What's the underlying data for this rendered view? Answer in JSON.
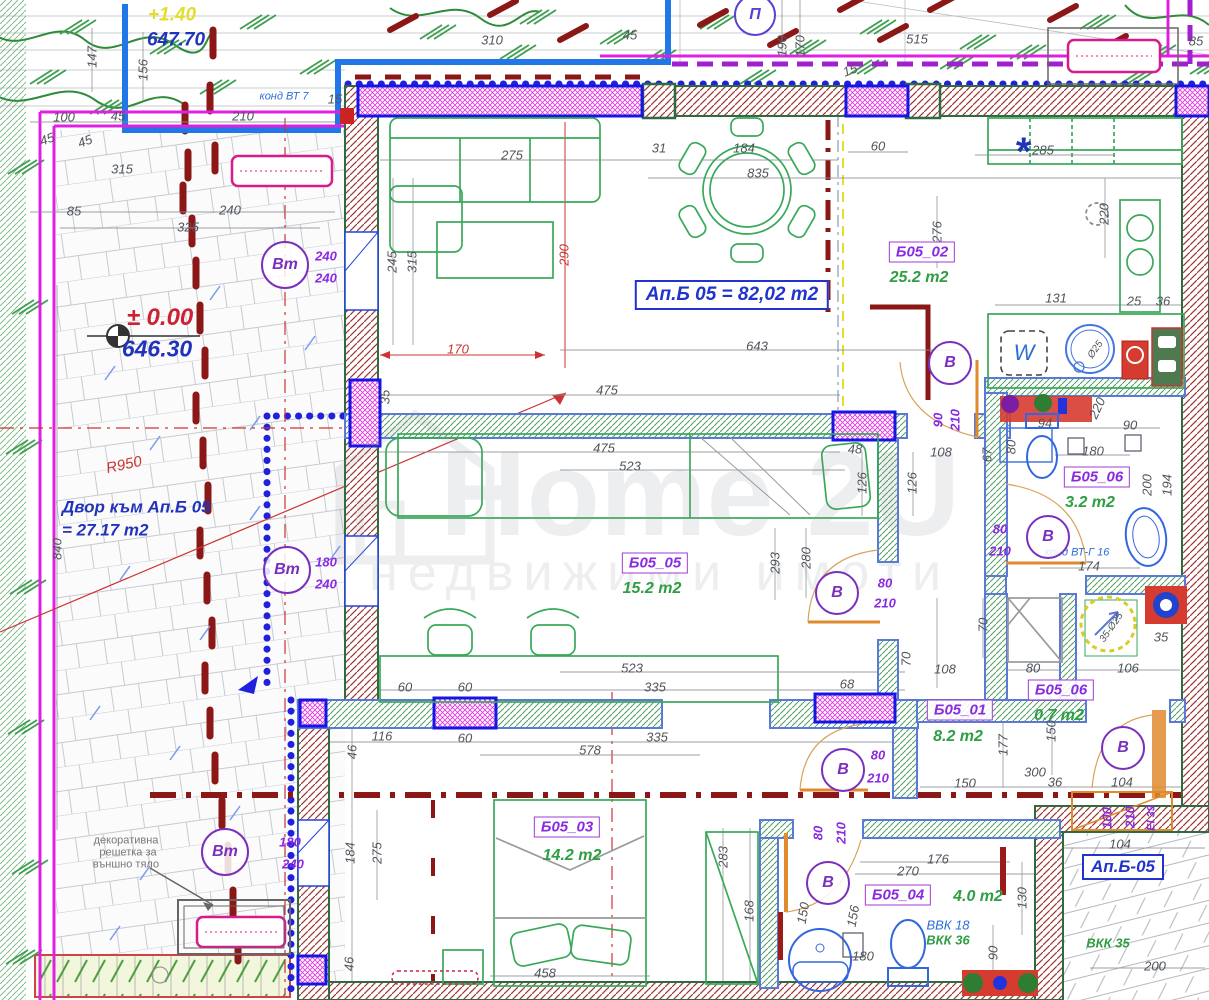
{
  "watermark": {
    "line1": "Home 2U",
    "line2": "недвижими имоти"
  },
  "boxes": [
    {
      "t": "Ап.Б 05 = 82,02 m2",
      "x": 732,
      "y": 295,
      "cls": "title",
      "n": "apartment-title"
    },
    {
      "t": "Ап.Б-05",
      "x": 1123,
      "y": 867,
      "cls": "apt",
      "n": "terrace-label"
    }
  ],
  "rooms": [
    {
      "id": "Б05_02",
      "area": "25.2 m2",
      "lx": 922,
      "ly": 252,
      "ax": 919,
      "ay": 278
    },
    {
      "id": "Б05_05",
      "area": "15.2 m2",
      "lx": 655,
      "ly": 563,
      "ax": 652,
      "ay": 589
    },
    {
      "id": "Б05_06",
      "area": "3.2 m2",
      "lx": 1097,
      "ly": 477,
      "ax": 1090,
      "ay": 503
    },
    {
      "id": "Б05_06",
      "area": "0.7 m2",
      "lx": 1061,
      "ly": 690,
      "ax": 1059,
      "ay": 716
    },
    {
      "id": "Б05_01",
      "area": "8.2 m2",
      "lx": 960,
      "ly": 710,
      "ax": 958,
      "ay": 737
    },
    {
      "id": "Б05_03",
      "area": "14.2 m2",
      "lx": 567,
      "ly": 827,
      "ax": 572,
      "ay": 856
    },
    {
      "id": "Б05_04",
      "area": "4.0 m2",
      "lx": 898,
      "ly": 895,
      "ax": 978,
      "ay": 897
    }
  ],
  "door_circles": [
    {
      "t": "Вт",
      "x": 285,
      "y": 265,
      "k": "vt"
    },
    {
      "t": "Вт",
      "x": 287,
      "y": 570,
      "k": "vt"
    },
    {
      "t": "Вт",
      "x": 225,
      "y": 852,
      "k": "vt"
    },
    {
      "t": "В",
      "x": 950,
      "y": 363,
      "k": "v"
    },
    {
      "t": "В",
      "x": 1048,
      "y": 537,
      "k": "v"
    },
    {
      "t": "В",
      "x": 837,
      "y": 593,
      "k": "v"
    },
    {
      "t": "В",
      "x": 1123,
      "y": 748,
      "k": "v"
    },
    {
      "t": "В",
      "x": 843,
      "y": 770,
      "k": "v"
    },
    {
      "t": "В",
      "x": 828,
      "y": 883,
      "k": "v"
    },
    {
      "t": "П",
      "x": 755,
      "y": 15,
      "k": "p"
    }
  ],
  "annotations": [
    {
      "t": "+1.40",
      "x": 172,
      "y": 15,
      "c": "yellow",
      "s": 19,
      "n": "level-top"
    },
    {
      "t": "647.70",
      "x": 176,
      "y": 40,
      "c": "blueb",
      "s": 19,
      "n": "elevation-647"
    },
    {
      "t": "конд ВТ 7",
      "x": 284,
      "y": 97,
      "c": "blue",
      "s": 11,
      "n": "cond-vt7"
    },
    {
      "t": "147",
      "x": 92,
      "y": 57,
      "r": -90
    },
    {
      "t": "156",
      "x": 143,
      "y": 70,
      "r": -90
    },
    {
      "t": "100",
      "x": 64,
      "y": 117
    },
    {
      "t": "45",
      "x": 118,
      "y": 116
    },
    {
      "t": "210",
      "x": 243,
      "y": 116
    },
    {
      "t": "15",
      "x": 335,
      "y": 99
    },
    {
      "t": "310",
      "x": 492,
      "y": 40
    },
    {
      "t": "45",
      "x": 630,
      "y": 35
    },
    {
      "t": "15",
      "x": 850,
      "y": 70,
      "r": -20
    },
    {
      "t": "190",
      "x": 782,
      "y": 46,
      "r": -90
    },
    {
      "t": "170",
      "x": 800,
      "y": 46,
      "r": -90
    },
    {
      "t": "515",
      "x": 917,
      "y": 39
    },
    {
      "t": "85",
      "x": 1196,
      "y": 41
    },
    {
      "t": "45",
      "x": 47,
      "y": 139,
      "r": -20
    },
    {
      "t": "45",
      "x": 85,
      "y": 141,
      "r": -20
    },
    {
      "t": "315",
      "x": 122,
      "y": 169
    },
    {
      "t": "85",
      "x": 74,
      "y": 211
    },
    {
      "t": "240",
      "x": 230,
      "y": 210
    },
    {
      "t": "325",
      "x": 188,
      "y": 227
    },
    {
      "t": "240",
      "x": 326,
      "y": 256,
      "c": "purp"
    },
    {
      "t": "240",
      "x": 326,
      "y": 278,
      "c": "purp"
    },
    {
      "t": "245",
      "x": 392,
      "y": 262,
      "r": -90
    },
    {
      "t": "315",
      "x": 412,
      "y": 262,
      "r": -90
    },
    {
      "t": "275",
      "x": 512,
      "y": 155
    },
    {
      "t": "31",
      "x": 659,
      "y": 148
    },
    {
      "t": "184",
      "x": 744,
      "y": 148
    },
    {
      "t": "835",
      "x": 758,
      "y": 173
    },
    {
      "t": "290",
      "x": 564,
      "y": 255,
      "r": -90,
      "c": "red"
    },
    {
      "t": "60",
      "x": 878,
      "y": 146
    },
    {
      "t": "285",
      "x": 1043,
      "y": 150
    },
    {
      "t": "220",
      "x": 1104,
      "y": 214,
      "r": -90
    },
    {
      "t": "276",
      "x": 937,
      "y": 232,
      "r": -90
    },
    {
      "t": "131",
      "x": 1056,
      "y": 298
    },
    {
      "t": "25",
      "x": 1134,
      "y": 301
    },
    {
      "t": "36",
      "x": 1163,
      "y": 301
    },
    {
      "t": "170",
      "x": 458,
      "y": 349,
      "c": "red"
    },
    {
      "t": "643",
      "x": 757,
      "y": 346
    },
    {
      "t": "35",
      "x": 385,
      "y": 397,
      "r": -90
    },
    {
      "t": "475",
      "x": 607,
      "y": 390
    },
    {
      "t": "90",
      "x": 938,
      "y": 420,
      "r": -90,
      "c": "purp"
    },
    {
      "t": "210",
      "x": 955,
      "y": 420,
      "r": -90,
      "c": "purp"
    },
    {
      "t": "94",
      "x": 1045,
      "y": 423
    },
    {
      "t": "90",
      "x": 1130,
      "y": 425
    },
    {
      "t": "220",
      "x": 1097,
      "y": 408,
      "r": -65
    },
    {
      "t": "Ø25",
      "x": 1096,
      "y": 350,
      "r": -55,
      "s": 10
    },
    {
      "t": "475",
      "x": 604,
      "y": 448
    },
    {
      "t": "523",
      "x": 630,
      "y": 466
    },
    {
      "t": "48",
      "x": 855,
      "y": 449
    },
    {
      "t": "126",
      "x": 862,
      "y": 483,
      "r": -90
    },
    {
      "t": "126",
      "x": 912,
      "y": 483,
      "r": -90
    },
    {
      "t": "108",
      "x": 941,
      "y": 452
    },
    {
      "t": "67",
      "x": 987,
      "y": 455,
      "r": -90
    },
    {
      "t": "80",
      "x": 1011,
      "y": 447,
      "r": -90
    },
    {
      "t": "180",
      "x": 1093,
      "y": 451
    },
    {
      "t": "200",
      "x": 1147,
      "y": 485,
      "r": -90
    },
    {
      "t": "194",
      "x": 1167,
      "y": 485,
      "r": -90
    },
    {
      "t": "80",
      "x": 1000,
      "y": 529,
      "c": "purp"
    },
    {
      "t": "210",
      "x": 1000,
      "y": 551,
      "c": "purp"
    },
    {
      "t": "конд ВТ-Г 16",
      "x": 1077,
      "y": 553,
      "c": "blue",
      "s": 11,
      "n": "cond-vt-g16"
    },
    {
      "t": "174",
      "x": 1089,
      "y": 566
    },
    {
      "t": "293",
      "x": 775,
      "y": 563,
      "r": -90
    },
    {
      "t": "280",
      "x": 806,
      "y": 558,
      "r": -90
    },
    {
      "t": "80",
      "x": 885,
      "y": 583,
      "c": "purp"
    },
    {
      "t": "210",
      "x": 885,
      "y": 603,
      "c": "purp"
    },
    {
      "t": "180",
      "x": 326,
      "y": 562,
      "c": "purp"
    },
    {
      "t": "240",
      "x": 326,
      "y": 584,
      "c": "purp"
    },
    {
      "t": "35",
      "x": 1161,
      "y": 637
    },
    {
      "t": "35-Ø25",
      "x": 1112,
      "y": 628,
      "r": -55,
      "s": 10
    },
    {
      "t": "106",
      "x": 1128,
      "y": 668
    },
    {
      "t": "108",
      "x": 945,
      "y": 669
    },
    {
      "t": "80",
      "x": 1033,
      "y": 668
    },
    {
      "t": "70",
      "x": 983,
      "y": 625,
      "r": -90
    },
    {
      "t": "70",
      "x": 906,
      "y": 659,
      "r": -90
    },
    {
      "t": "523",
      "x": 632,
      "y": 668
    },
    {
      "t": "335",
      "x": 655,
      "y": 687
    },
    {
      "t": "68",
      "x": 847,
      "y": 684
    },
    {
      "t": "60",
      "x": 405,
      "y": 687
    },
    {
      "t": "60",
      "x": 465,
      "y": 687
    },
    {
      "t": "116",
      "x": 382,
      "y": 736
    },
    {
      "t": "60",
      "x": 465,
      "y": 738
    },
    {
      "t": "335",
      "x": 657,
      "y": 737
    },
    {
      "t": "578",
      "x": 590,
      "y": 750
    },
    {
      "t": "46",
      "x": 352,
      "y": 752,
      "r": -90
    },
    {
      "t": "177",
      "x": 1003,
      "y": 745,
      "r": -90
    },
    {
      "t": "150",
      "x": 1051,
      "y": 731,
      "r": -90
    },
    {
      "t": "150",
      "x": 965,
      "y": 783
    },
    {
      "t": "300",
      "x": 1035,
      "y": 772
    },
    {
      "t": "36",
      "x": 1055,
      "y": 782
    },
    {
      "t": "104",
      "x": 1122,
      "y": 782
    },
    {
      "t": "80",
      "x": 878,
      "y": 755,
      "c": "purp"
    },
    {
      "t": "210",
      "x": 878,
      "y": 778,
      "c": "purp"
    },
    {
      "t": "100",
      "x": 1107,
      "y": 818,
      "r": -90,
      "c": "purp"
    },
    {
      "t": "210",
      "x": 1130,
      "y": 817,
      "r": -90,
      "c": "purp"
    },
    {
      "t": "EI 39",
      "x": 1152,
      "y": 818,
      "r": -90,
      "c": "purp",
      "s": 11
    },
    {
      "t": "104",
      "x": 1120,
      "y": 844
    },
    {
      "t": "184",
      "x": 350,
      "y": 853,
      "r": -90
    },
    {
      "t": "275",
      "x": 377,
      "y": 853,
      "r": -90
    },
    {
      "t": "80",
      "x": 818,
      "y": 833,
      "r": -90,
      "c": "purp"
    },
    {
      "t": "210",
      "x": 841,
      "y": 833,
      "r": -90,
      "c": "purp"
    },
    {
      "t": "176",
      "x": 938,
      "y": 859
    },
    {
      "t": "270",
      "x": 908,
      "y": 871
    },
    {
      "t": "283",
      "x": 723,
      "y": 857,
      "r": -90
    },
    {
      "t": "168",
      "x": 749,
      "y": 911,
      "r": -90
    },
    {
      "t": "150",
      "x": 803,
      "y": 913,
      "r": -80
    },
    {
      "t": "156",
      "x": 853,
      "y": 916,
      "r": -80
    },
    {
      "t": "130",
      "x": 1022,
      "y": 898,
      "r": -90
    },
    {
      "t": "180",
      "x": 863,
      "y": 956
    },
    {
      "t": "90",
      "x": 993,
      "y": 953,
      "r": -90
    },
    {
      "t": "46",
      "x": 349,
      "y": 964,
      "r": -90
    },
    {
      "t": "458",
      "x": 545,
      "y": 973
    },
    {
      "t": "200",
      "x": 1155,
      "y": 966
    },
    {
      "t": "ВКК 35",
      "x": 1108,
      "y": 943,
      "c": "green2",
      "s": 13,
      "n": "vkk35"
    },
    {
      "t": "ВВК 18",
      "x": 948,
      "y": 925,
      "c": "blue",
      "s": 13,
      "n": "vvk18"
    },
    {
      "t": "ВКК 36",
      "x": 948,
      "y": 940,
      "c": "green2",
      "s": 13,
      "n": "vkk36"
    },
    {
      "t": "180",
      "x": 290,
      "y": 842,
      "c": "purp"
    },
    {
      "t": "240",
      "x": 293,
      "y": 864,
      "c": "purp"
    },
    {
      "t": "840",
      "x": 57,
      "y": 549,
      "r": -90
    },
    {
      "t": "R950",
      "x": 124,
      "y": 465,
      "c": "red",
      "s": 15,
      "r": -12,
      "n": "radius-label"
    },
    {
      "t": "± 0.00",
      "x": 160,
      "y": 318,
      "c": "levelred",
      "s": 24,
      "n": "level-zero"
    },
    {
      "t": "646.30",
      "x": 157,
      "y": 349,
      "c": "blueb",
      "s": 23,
      "n": "elevation-646"
    },
    {
      "t": "Двор към Ап.Б 05",
      "x": 62,
      "y": 507,
      "c": "blueb",
      "s": 17,
      "a": "start",
      "n": "yard-label"
    },
    {
      "t": "= 27.17 m2",
      "x": 62,
      "y": 530,
      "c": "blueb",
      "s": 17,
      "a": "start",
      "n": "yard-area"
    },
    {
      "t": "декоративна",
      "x": 126,
      "y": 841,
      "c": "gray",
      "s": 11
    },
    {
      "t": "решетка за",
      "x": 128,
      "y": 853,
      "c": "gray",
      "s": 11
    },
    {
      "t": "външно тяло",
      "x": 126,
      "y": 865,
      "c": "gray",
      "s": 11
    },
    {
      "t": "*",
      "x": 1022,
      "y": 152,
      "c": "blueb",
      "s": 40,
      "n": "symbol-asterisk"
    },
    {
      "t": "W",
      "x": 1024,
      "y": 353,
      "c": "blue",
      "s": 22,
      "n": "washing-machine-label"
    }
  ],
  "colors": {
    "wall_hatch": "#9c2b2b",
    "wall_edge": "#2e6b40",
    "int_wall_edge": "#5b79d8",
    "window_frame": "#1515e6",
    "window_hatch": "#e23ae2",
    "boundary_blue": "#2020dd",
    "boundary_magenta": "#e020e0",
    "boundary_purple": "#a020d0",
    "furniture": "#3aa85a",
    "dims": "#50555b",
    "doors": "#e08a2e",
    "projection": "#8b1717"
  }
}
